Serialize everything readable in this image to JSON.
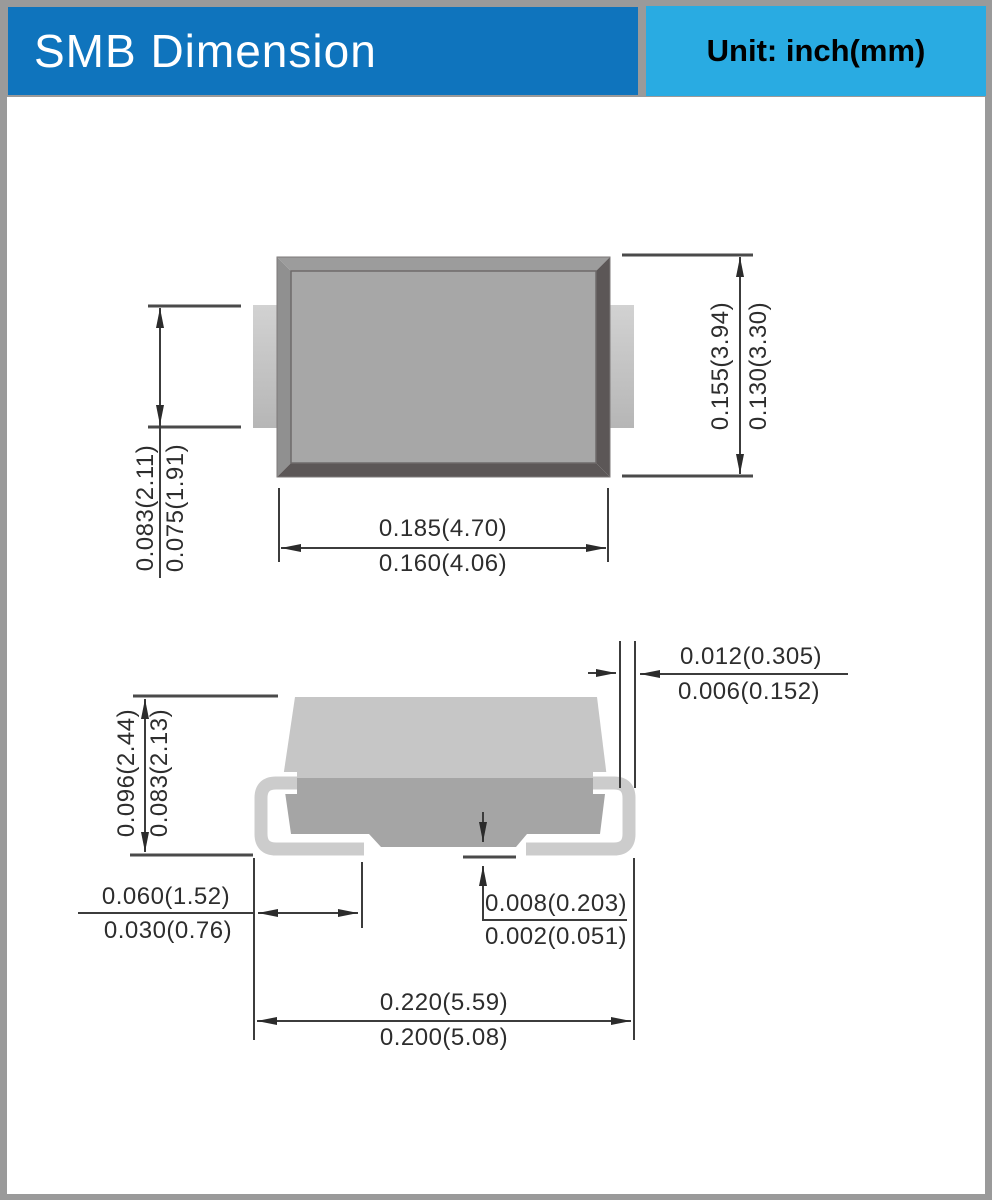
{
  "header": {
    "title": "SMB Dimension",
    "unit_label": "Unit: inch(mm)"
  },
  "colors": {
    "header_blue": "#0f74bd",
    "header_cyan": "#29abe2",
    "frame_gray": "#9a9a9a",
    "body_face_gray": "#a7a7a7",
    "bevel_dark": "#5c5757",
    "lead_gray": "#cccccc",
    "line_color": "#3c3c3c",
    "text_color": "#2d2d2d"
  },
  "top_view": {
    "dims": {
      "terminal_height": {
        "max": "0.083(2.11)",
        "min": "0.075(1.91)"
      },
      "body_height": {
        "max": "0.155(3.94)",
        "min": "0.130(3.30)"
      },
      "body_width": {
        "max": "0.185(4.70)",
        "min": "0.160(4.06)"
      }
    }
  },
  "side_view": {
    "dims": {
      "lead_thickness": {
        "max": "0.012(0.305)",
        "min": "0.006(0.152)"
      },
      "body_height": {
        "max": "0.096(2.44)",
        "min": "0.083(2.13)"
      },
      "foot_length": {
        "max": "0.060(1.52)",
        "min": "0.030(0.76)"
      },
      "standoff": {
        "max": "0.008(0.203)",
        "min": "0.002(0.051)"
      },
      "overall_width": {
        "max": "0.220(5.59)",
        "min": "0.200(5.08)"
      }
    }
  }
}
